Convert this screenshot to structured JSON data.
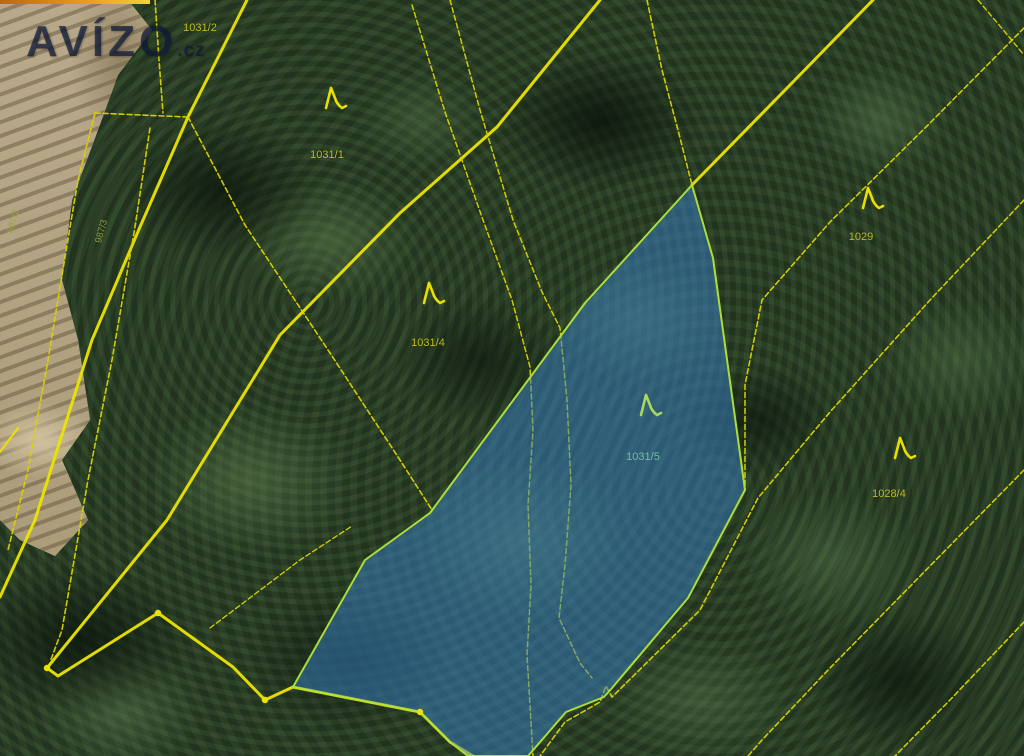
{
  "watermark": {
    "brand": "AVÍZO",
    "suffix": ".cz"
  },
  "top_bar": {
    "color_start": "#b86a10",
    "color_mid": "#e8a020",
    "color_end": "#f5cf3a"
  },
  "map": {
    "line_color": "#ece400",
    "dash_color": "#d9d300",
    "label_colors": {
      "normal": "#c9c31f",
      "blue": "#7cc4a0",
      "dim": "#99a23e"
    },
    "tree_colors": {
      "normal": "#e8df00",
      "blue": "#a8d95c"
    },
    "highlighted_parcel": {
      "label": "1031/5",
      "fill": "rgba(56,128,200,0.52)",
      "stroke": "#b2e23a",
      "points": "692,185 713,258 745,490 688,598 612,688 604,697 566,712 528,756 468,756 450,742 420,712 293,687 365,560 430,513 585,303"
    },
    "boundary_lines": [
      {
        "points": "600,0 497,127 400,213 280,335 167,520 47,668 58,676 158,613 233,667 265,700 293,687 420,712 450,742 473,756",
        "w": 3,
        "dash": false
      },
      {
        "points": "247,0 188,117 140,227 92,340 35,520 0,597",
        "w": 3,
        "dash": false
      },
      {
        "points": "692,185 790,85 873,0",
        "w": 3,
        "dash": false
      },
      {
        "points": "155,0 159,60 163,113",
        "w": 1.6,
        "dash": true
      },
      {
        "points": "95,113 187,117",
        "w": 1.6,
        "dash": true
      },
      {
        "points": "95,113 78,180 65,257 48,360 28,470 8,550",
        "w": 1.6,
        "dash": true
      },
      {
        "points": "150,128 135,227 112,360 88,480 62,630 50,662",
        "w": 1.6,
        "dash": true
      },
      {
        "points": "188,117 245,225 330,353 400,460 432,510",
        "w": 1.6,
        "dash": true
      },
      {
        "points": "412,5 445,112 483,220 512,300 530,367 533,430 528,505 531,585 527,655 533,756",
        "w": 1.5,
        "dash": true
      },
      {
        "points": "450,0 480,110 513,220 542,292 560,328 567,400 571,485 565,565 559,618 580,663 592,678",
        "w": 1.5,
        "dash": true
      },
      {
        "points": "647,0 662,70 678,130 692,185",
        "w": 1.6,
        "dash": true
      },
      {
        "points": "1024,28 928,125 830,222 762,300 745,385 745,490",
        "w": 1.6,
        "dash": true
      },
      {
        "points": "1024,200 930,300 830,412 758,498 700,610 612,697 606,686 600,702 565,722 540,756",
        "w": 1.6,
        "dash": true
      },
      {
        "points": "1024,470 930,566 830,668 762,740 748,756",
        "w": 1.6,
        "dash": true
      },
      {
        "points": "1024,622 950,700 895,756",
        "w": 1.6,
        "dash": true
      },
      {
        "points": "978,0 1010,38 1024,55",
        "w": 1.4,
        "dash": true
      },
      {
        "points": "0,452 18,428",
        "w": 2,
        "dash": false
      },
      {
        "points": "210,628 300,560 352,526",
        "w": 1.4,
        "dash": true
      }
    ],
    "survey_points": [
      {
        "x": 47,
        "y": 668
      },
      {
        "x": 158,
        "y": 613
      },
      {
        "x": 265,
        "y": 700
      },
      {
        "x": 420,
        "y": 712
      }
    ],
    "tree_symbols": [
      {
        "x": 332,
        "y": 102,
        "tint": "normal"
      },
      {
        "x": 430,
        "y": 297,
        "tint": "normal"
      },
      {
        "x": 647,
        "y": 409,
        "tint": "blue"
      },
      {
        "x": 869,
        "y": 202,
        "tint": "normal"
      },
      {
        "x": 901,
        "y": 452,
        "tint": "normal"
      }
    ],
    "parcel_labels": [
      {
        "text": "1031/2",
        "x": 200,
        "y": 31,
        "rot": 0,
        "tint": "normal"
      },
      {
        "text": "1031/1",
        "x": 327,
        "y": 158,
        "rot": 0,
        "tint": "normal"
      },
      {
        "text": "1031/4",
        "x": 428,
        "y": 346,
        "rot": 0,
        "tint": "normal"
      },
      {
        "text": "1031/5",
        "x": 643,
        "y": 460,
        "rot": 0,
        "tint": "blue"
      },
      {
        "text": "1029",
        "x": 861,
        "y": 240,
        "rot": 0,
        "tint": "normal"
      },
      {
        "text": "1028/4",
        "x": 889,
        "y": 497,
        "rot": 0,
        "tint": "normal"
      },
      {
        "text": "887/2",
        "x": 16,
        "y": 222,
        "rot": -75,
        "tint": "dim"
      },
      {
        "text": "987/3",
        "x": 104,
        "y": 232,
        "rot": -75,
        "tint": "dim"
      }
    ]
  }
}
